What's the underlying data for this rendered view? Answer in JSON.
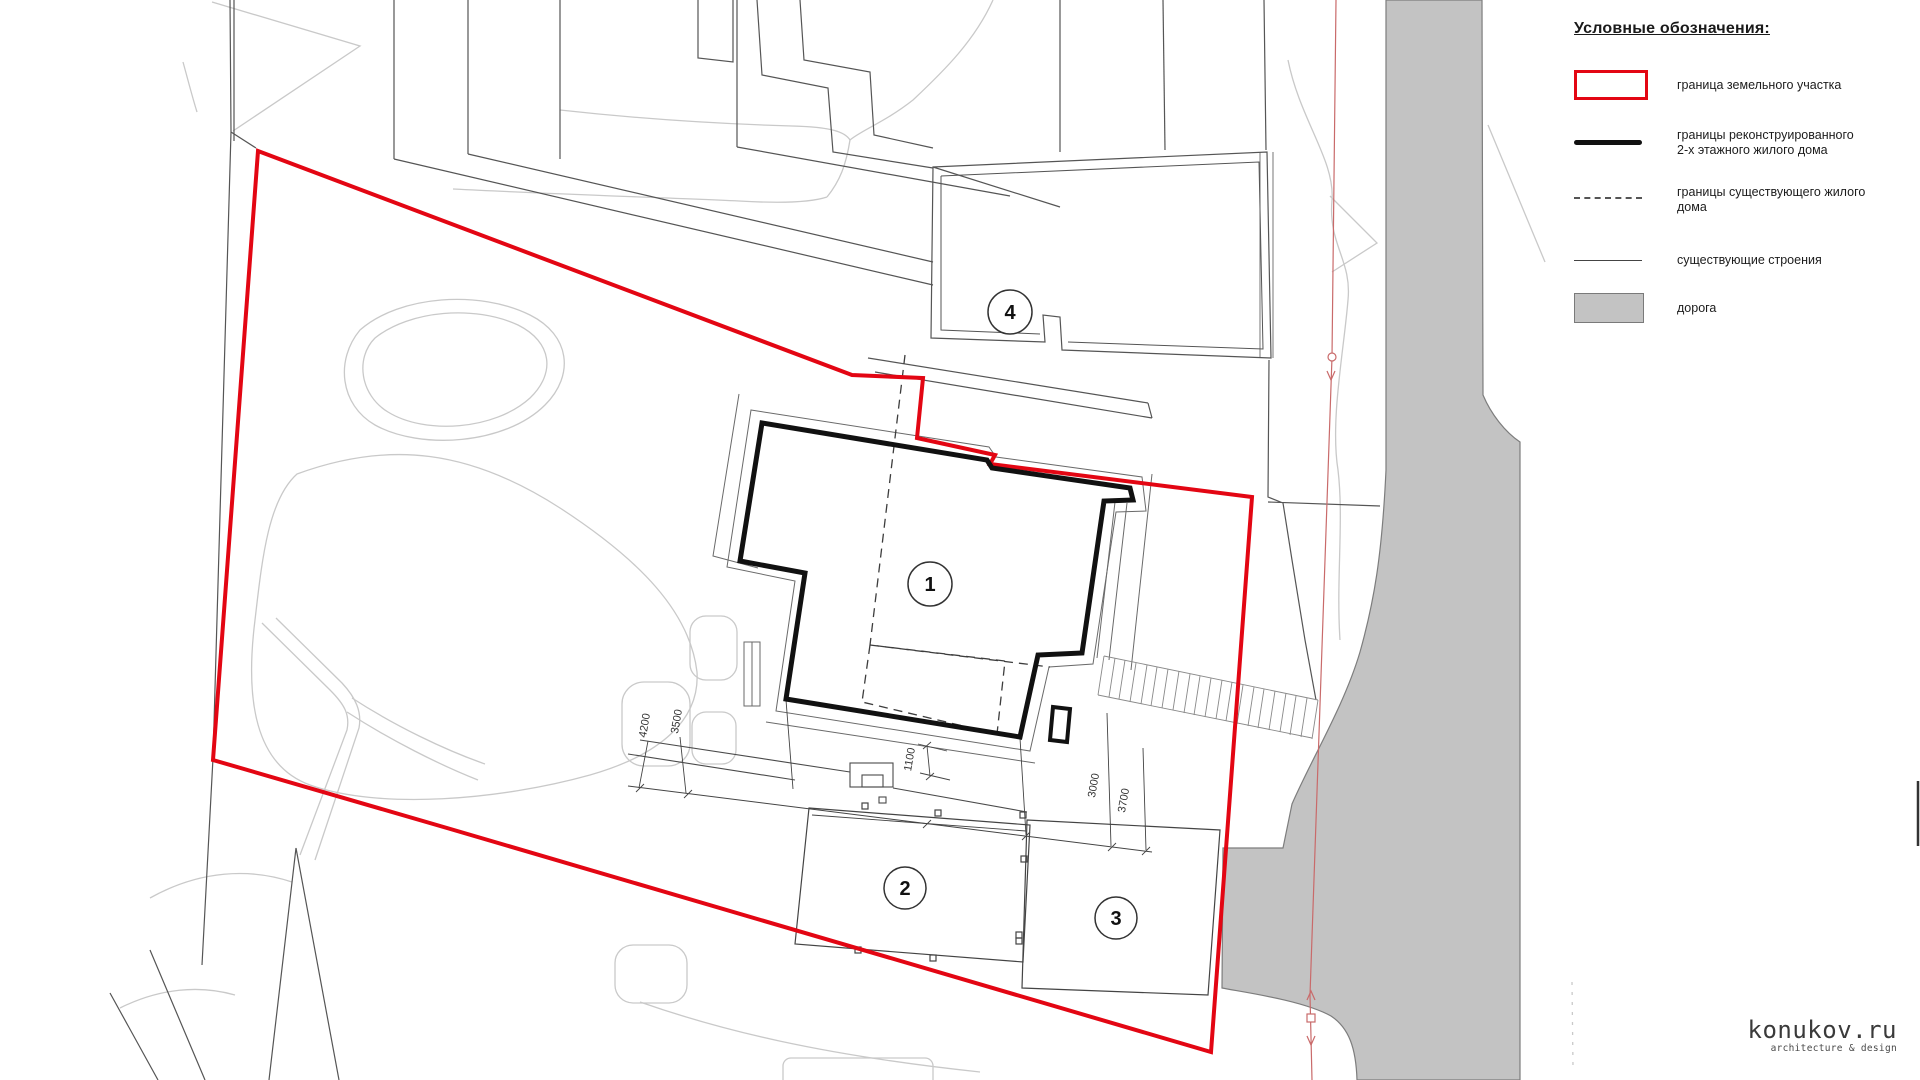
{
  "legend": {
    "title": "Условные обозначения:",
    "items": [
      {
        "key": "parcel-boundary",
        "line1": "граница земельного участка",
        "line2": ""
      },
      {
        "key": "reconstructed-boundary",
        "line1": "границы реконструированного",
        "line2": "2-х этажного жилого дома"
      },
      {
        "key": "existing-house",
        "line1": "границы существующего жилого",
        "line2": "дома"
      },
      {
        "key": "existing-structures",
        "line1": "существующие строения",
        "line2": ""
      },
      {
        "key": "road",
        "line1": "дорога",
        "line2": ""
      }
    ]
  },
  "plan": {
    "markers": [
      {
        "label": "1"
      },
      {
        "label": "2"
      },
      {
        "label": "3"
      },
      {
        "label": "4"
      }
    ],
    "dimensions": [
      {
        "label": "4200"
      },
      {
        "label": "3500"
      },
      {
        "label": "1100"
      },
      {
        "label": "3000"
      },
      {
        "label": "3700"
      }
    ]
  },
  "logo": {
    "name": "konukov.ru",
    "tagline": "architecture & design"
  },
  "colors": {
    "parcel_boundary": "#e30613",
    "reconstructed_building": "#111111",
    "existing_lines": "#555555",
    "terrain_lines": "#c9c9c9",
    "road_fill": "#c3c3c3",
    "road_edge": "#7d7d7d",
    "utility_line": "#c96a6a"
  }
}
